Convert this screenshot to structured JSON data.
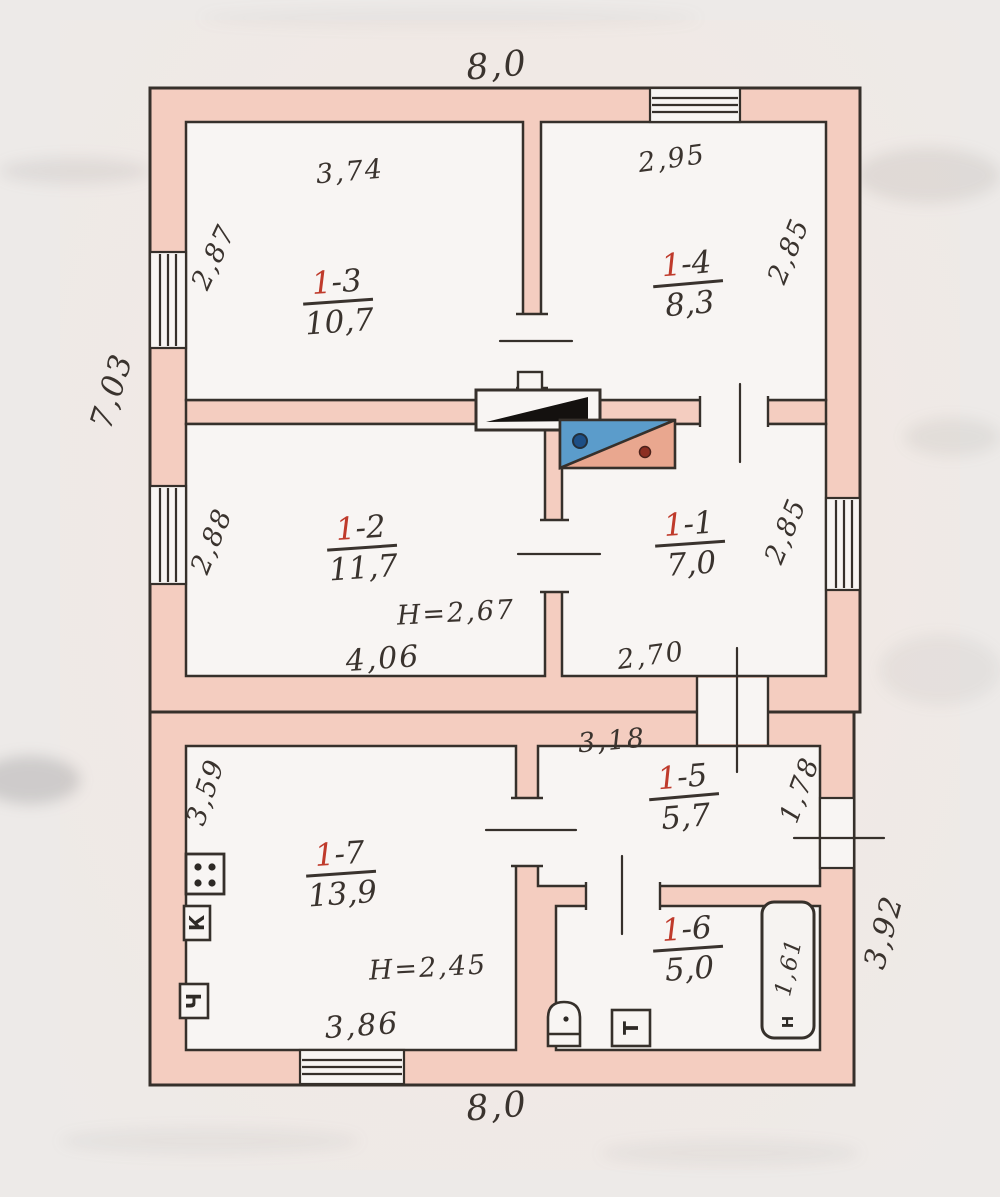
{
  "document": {
    "type_label": "floor-plan-scan"
  },
  "colors": {
    "wall": "#f4cdc0",
    "ink": "#36302b",
    "room_fill": "#f8f5f3",
    "red_accent": "#bf3a2b",
    "gas_blue": "#5b9ccb",
    "gas_salmon": "#e9a78f",
    "stove_black": "#14110f",
    "paper": "#edeae8"
  },
  "rooms": [
    {
      "id": "1-1",
      "num_red": "1",
      "num_rest": "-1",
      "area": "7,0"
    },
    {
      "id": "1-2",
      "num_red": "1",
      "num_rest": "-2",
      "area": "11,7"
    },
    {
      "id": "1-3",
      "num_red": "1",
      "num_rest": "-3",
      "area": "10,7"
    },
    {
      "id": "1-4",
      "num_red": "1",
      "num_rest": "-4",
      "area": "8,3"
    },
    {
      "id": "1-5",
      "num_red": "1",
      "num_rest": "-5",
      "area": "5,7"
    },
    {
      "id": "1-6",
      "num_red": "1",
      "num_rest": "-6",
      "area": "5,0"
    },
    {
      "id": "1-7",
      "num_red": "1",
      "num_rest": "-7",
      "area": "13,9"
    }
  ],
  "heights": {
    "upper": "H=2,67",
    "lower": "H=2,45"
  },
  "dimensions": {
    "top_width": "8,0",
    "bottom_width": "8,0",
    "left_height": "7,03",
    "r13_w": "3,74",
    "r13_h": "2,87",
    "r14_w": "2,95",
    "r14_h": "2,85",
    "r12_w": "4,06",
    "r12_h": "2,88",
    "r11_w": "2,70",
    "r11_h": "2,85",
    "r15_w": "3,18",
    "r15_h": "1,78",
    "r17_w": "3,86",
    "r17_h": "3,59",
    "r16_bath": "1,61",
    "right_lower_h": "3,92"
  },
  "fixtures": {
    "letter_k": "К",
    "letter_ch": "Ч",
    "letter_t": "Т",
    "letter_n": "Н"
  }
}
